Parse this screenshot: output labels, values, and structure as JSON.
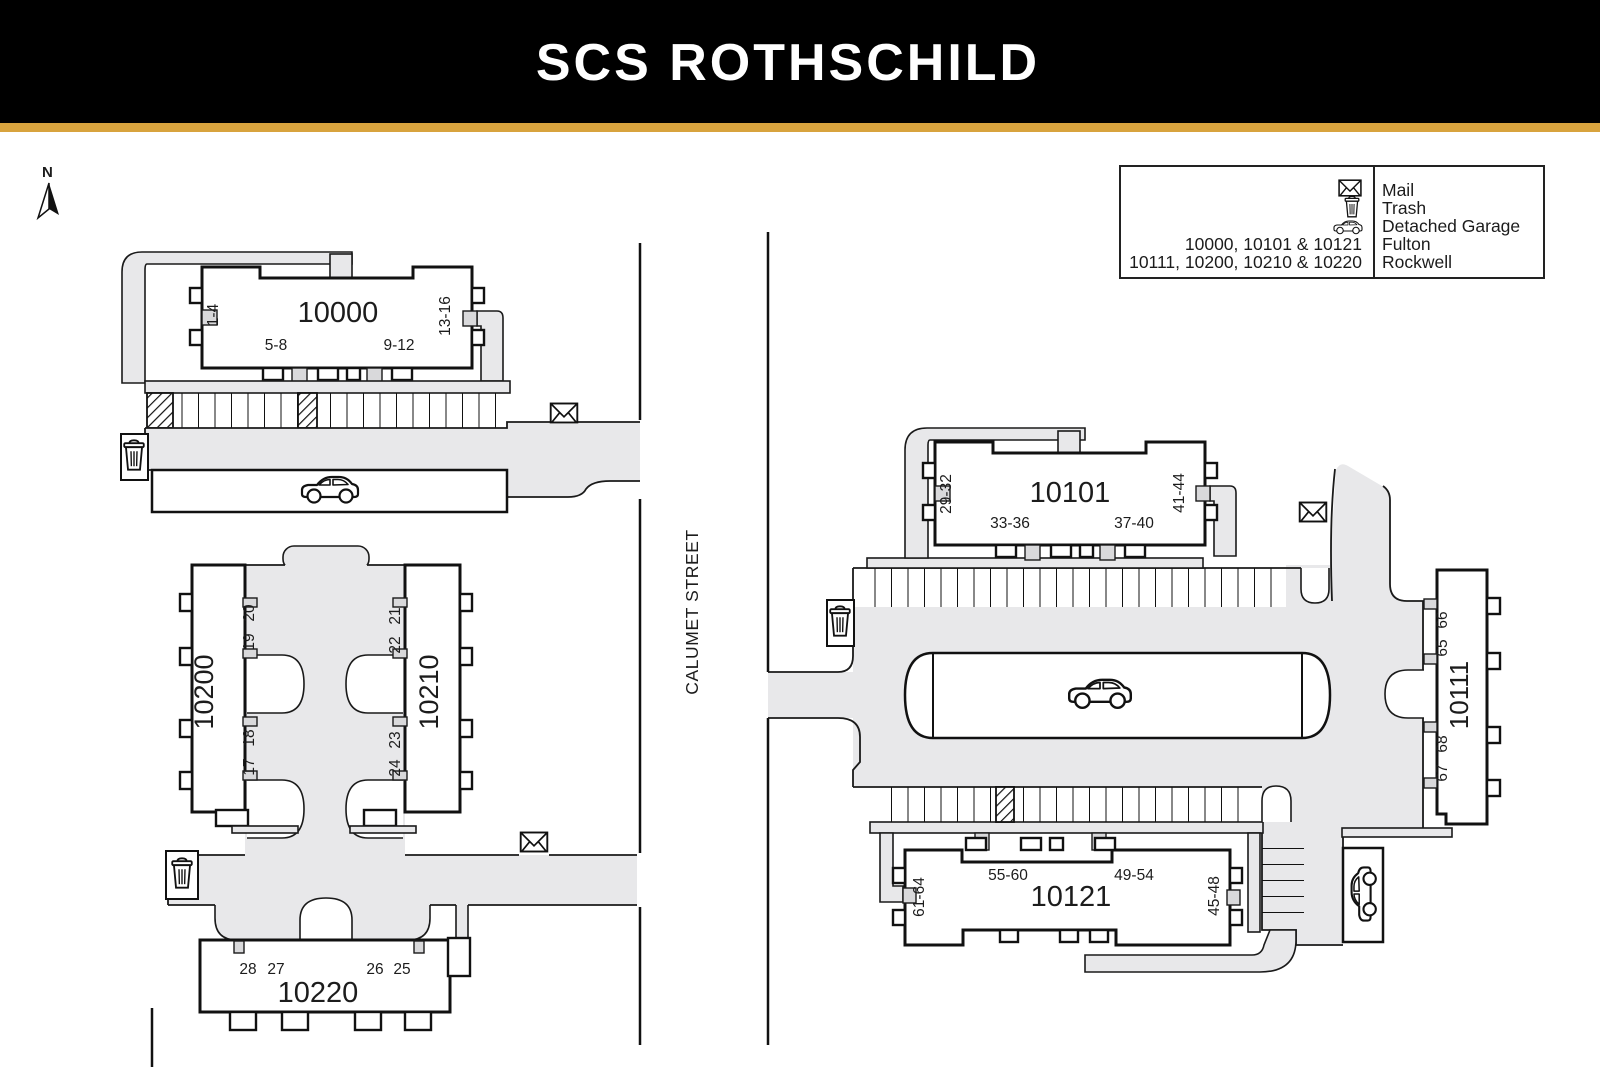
{
  "header": {
    "title": "SCS ROTHSCHILD"
  },
  "compass": {
    "north": "N"
  },
  "street": {
    "name": "CALUMET STREET"
  },
  "legend": {
    "mail": "Mail",
    "trash": "Trash",
    "detached_garage": "Detached Garage",
    "fulton": "Fulton",
    "rockwell": "Rockwell",
    "fulton_buildings": "10000, 10101 & 10121",
    "rockwell_buildings": "10111, 10200, 10210 & 10220"
  },
  "buildings": {
    "b10000": {
      "name": "10000",
      "units_left": "1-4",
      "units_bottom_left": "5-8",
      "units_bottom_right": "9-12",
      "units_right": "13-16"
    },
    "b10101": {
      "name": "10101",
      "units_left": "29-32",
      "units_bottom_left": "33-36",
      "units_bottom_right": "37-40",
      "units_right": "41-44"
    },
    "b10121": {
      "name": "10121",
      "units_left": "61-64",
      "units_top_left": "55-60",
      "units_top_right": "49-54",
      "units_right": "45-48"
    },
    "b10111": {
      "name": "10111",
      "unit1": "66",
      "unit2": "65",
      "unit3": "68",
      "unit4": "67"
    },
    "b10200": {
      "name": "10200",
      "unit1": "20",
      "unit2": "19",
      "unit3": "18",
      "unit4": "17"
    },
    "b10210": {
      "name": "10210",
      "unit1": "21",
      "unit2": "22",
      "unit3": "23",
      "unit4": "24"
    },
    "b10220": {
      "name": "10220",
      "unit1": "28",
      "unit2": "27",
      "unit3": "26",
      "unit4": "25"
    }
  },
  "colors": {
    "header_bg": "#000000",
    "accent_gold": "#d8a33e",
    "path_gray": "#e8e8ea",
    "line": "#1a1a1a"
  }
}
